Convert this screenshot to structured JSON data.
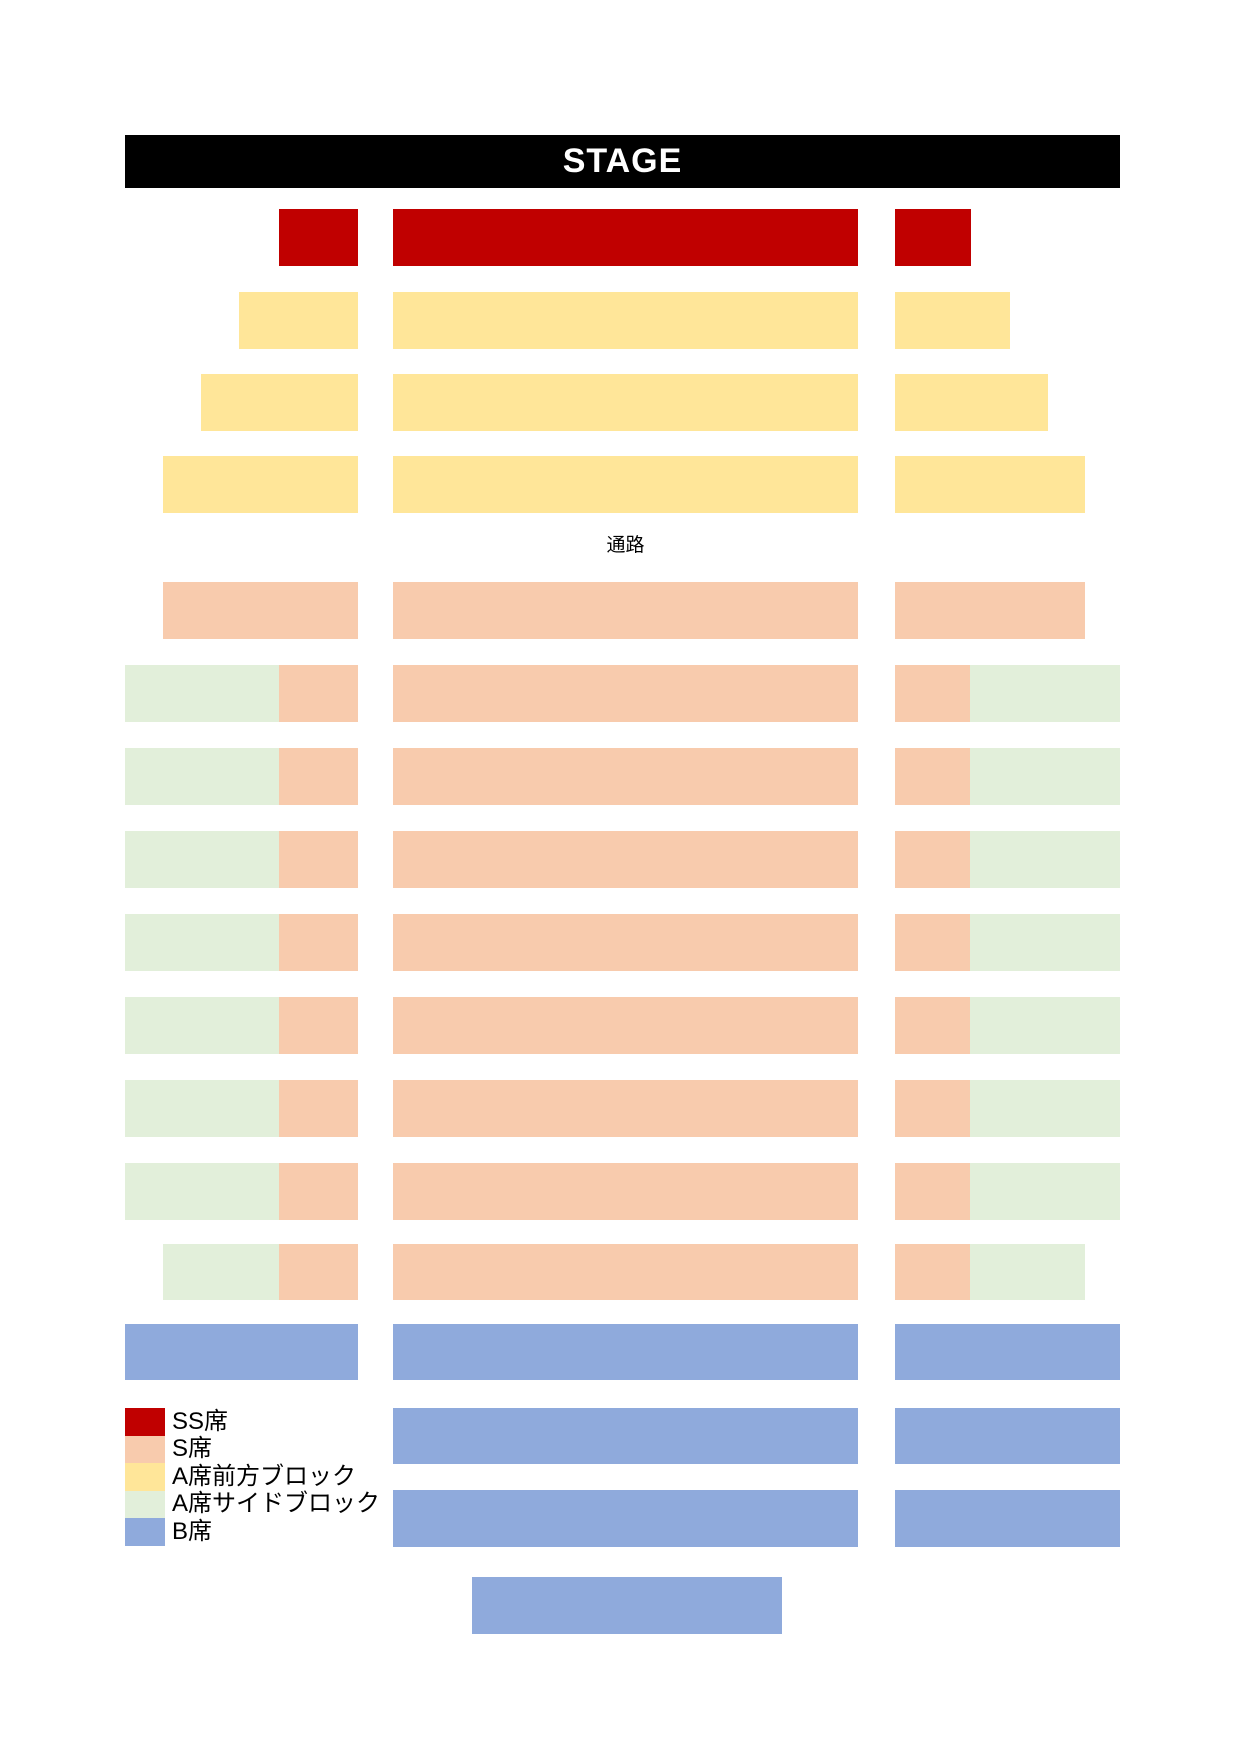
{
  "stage": {
    "label": "STAGE"
  },
  "aisle_label": "通路",
  "colors": {
    "background": "#ffffff",
    "stage_bg": "#000000",
    "stage_text": "#ffffff",
    "aisle_text": "#000000",
    "ss": "#c00000",
    "s": "#f8cbad",
    "a_front": "#ffe699",
    "a_side": "#e2efda",
    "b": "#8faadc"
  },
  "legend": {
    "items": [
      {
        "type": "ss",
        "label": "SS席"
      },
      {
        "type": "s",
        "label": "S席"
      },
      {
        "type": "a_front",
        "label": "A席前方ブロック"
      },
      {
        "type": "a_side",
        "label": "A席サイドブロック"
      },
      {
        "type": "b",
        "label": "B席"
      }
    ]
  },
  "seat_map": {
    "rows": [
      {
        "name": "row-1",
        "top": 209,
        "height": 57,
        "blocks": [
          {
            "type": "ss",
            "left": 279,
            "width": 79
          },
          {
            "type": "ss",
            "left": 393,
            "width": 465
          },
          {
            "type": "ss",
            "left": 895,
            "width": 76
          }
        ]
      },
      {
        "name": "row-2",
        "top": 292,
        "height": 57,
        "blocks": [
          {
            "type": "a_front",
            "left": 239,
            "width": 119
          },
          {
            "type": "a_front",
            "left": 393,
            "width": 465
          },
          {
            "type": "a_front",
            "left": 895,
            "width": 115
          }
        ]
      },
      {
        "name": "row-3",
        "top": 374,
        "height": 57,
        "blocks": [
          {
            "type": "a_front",
            "left": 201,
            "width": 157
          },
          {
            "type": "a_front",
            "left": 393,
            "width": 465
          },
          {
            "type": "a_front",
            "left": 895,
            "width": 153
          }
        ]
      },
      {
        "name": "row-4",
        "top": 456,
        "height": 57,
        "blocks": [
          {
            "type": "a_front",
            "left": 163,
            "width": 195
          },
          {
            "type": "a_front",
            "left": 393,
            "width": 465
          },
          {
            "type": "a_front",
            "left": 895,
            "width": 190
          }
        ]
      },
      {
        "name": "row-5",
        "top": 582,
        "height": 57,
        "blocks": [
          {
            "type": "s",
            "left": 163,
            "width": 195
          },
          {
            "type": "s",
            "left": 393,
            "width": 465
          },
          {
            "type": "s",
            "left": 895,
            "width": 190
          }
        ]
      },
      {
        "name": "row-6",
        "top": 665,
        "height": 57,
        "blocks": [
          {
            "type": "a_side",
            "left": 125,
            "width": 154
          },
          {
            "type": "s",
            "left": 279,
            "width": 79
          },
          {
            "type": "s",
            "left": 393,
            "width": 465
          },
          {
            "type": "s",
            "left": 895,
            "width": 75
          },
          {
            "type": "a_side",
            "left": 970,
            "width": 150
          }
        ]
      },
      {
        "name": "row-7",
        "top": 748,
        "height": 57,
        "blocks": [
          {
            "type": "a_side",
            "left": 125,
            "width": 154
          },
          {
            "type": "s",
            "left": 279,
            "width": 79
          },
          {
            "type": "s",
            "left": 393,
            "width": 465
          },
          {
            "type": "s",
            "left": 895,
            "width": 75
          },
          {
            "type": "a_side",
            "left": 970,
            "width": 150
          }
        ]
      },
      {
        "name": "row-8",
        "top": 831,
        "height": 57,
        "blocks": [
          {
            "type": "a_side",
            "left": 125,
            "width": 154
          },
          {
            "type": "s",
            "left": 279,
            "width": 79
          },
          {
            "type": "s",
            "left": 393,
            "width": 465
          },
          {
            "type": "s",
            "left": 895,
            "width": 75
          },
          {
            "type": "a_side",
            "left": 970,
            "width": 150
          }
        ]
      },
      {
        "name": "row-9",
        "top": 914,
        "height": 57,
        "blocks": [
          {
            "type": "a_side",
            "left": 125,
            "width": 154
          },
          {
            "type": "s",
            "left": 279,
            "width": 79
          },
          {
            "type": "s",
            "left": 393,
            "width": 465
          },
          {
            "type": "s",
            "left": 895,
            "width": 75
          },
          {
            "type": "a_side",
            "left": 970,
            "width": 150
          }
        ]
      },
      {
        "name": "row-10",
        "top": 997,
        "height": 57,
        "blocks": [
          {
            "type": "a_side",
            "left": 125,
            "width": 154
          },
          {
            "type": "s",
            "left": 279,
            "width": 79
          },
          {
            "type": "s",
            "left": 393,
            "width": 465
          },
          {
            "type": "s",
            "left": 895,
            "width": 75
          },
          {
            "type": "a_side",
            "left": 970,
            "width": 150
          }
        ]
      },
      {
        "name": "row-11",
        "top": 1080,
        "height": 57,
        "blocks": [
          {
            "type": "a_side",
            "left": 125,
            "width": 154
          },
          {
            "type": "s",
            "left": 279,
            "width": 79
          },
          {
            "type": "s",
            "left": 393,
            "width": 465
          },
          {
            "type": "s",
            "left": 895,
            "width": 75
          },
          {
            "type": "a_side",
            "left": 970,
            "width": 150
          }
        ]
      },
      {
        "name": "row-12",
        "top": 1163,
        "height": 57,
        "blocks": [
          {
            "type": "a_side",
            "left": 125,
            "width": 154
          },
          {
            "type": "s",
            "left": 279,
            "width": 79
          },
          {
            "type": "s",
            "left": 393,
            "width": 465
          },
          {
            "type": "s",
            "left": 895,
            "width": 75
          },
          {
            "type": "a_side",
            "left": 970,
            "width": 150
          }
        ]
      },
      {
        "name": "row-13",
        "top": 1244,
        "height": 56,
        "blocks": [
          {
            "type": "a_side",
            "left": 163,
            "width": 116
          },
          {
            "type": "s",
            "left": 279,
            "width": 79
          },
          {
            "type": "s",
            "left": 393,
            "width": 465
          },
          {
            "type": "s",
            "left": 895,
            "width": 75
          },
          {
            "type": "a_side",
            "left": 970,
            "width": 115
          }
        ]
      },
      {
        "name": "row-14",
        "top": 1324,
        "height": 56,
        "blocks": [
          {
            "type": "b",
            "left": 125,
            "width": 233
          },
          {
            "type": "b",
            "left": 393,
            "width": 465
          },
          {
            "type": "b",
            "left": 895,
            "width": 225
          }
        ]
      },
      {
        "name": "row-15",
        "top": 1408,
        "height": 56,
        "blocks": [
          {
            "type": "b",
            "left": 393,
            "width": 465
          },
          {
            "type": "b",
            "left": 895,
            "width": 225
          }
        ]
      },
      {
        "name": "row-16",
        "top": 1490,
        "height": 57,
        "blocks": [
          {
            "type": "b",
            "left": 393,
            "width": 465
          },
          {
            "type": "b",
            "left": 895,
            "width": 225
          }
        ]
      },
      {
        "name": "row-17",
        "top": 1577,
        "height": 57,
        "blocks": [
          {
            "type": "b",
            "left": 472,
            "width": 310
          }
        ]
      }
    ]
  }
}
